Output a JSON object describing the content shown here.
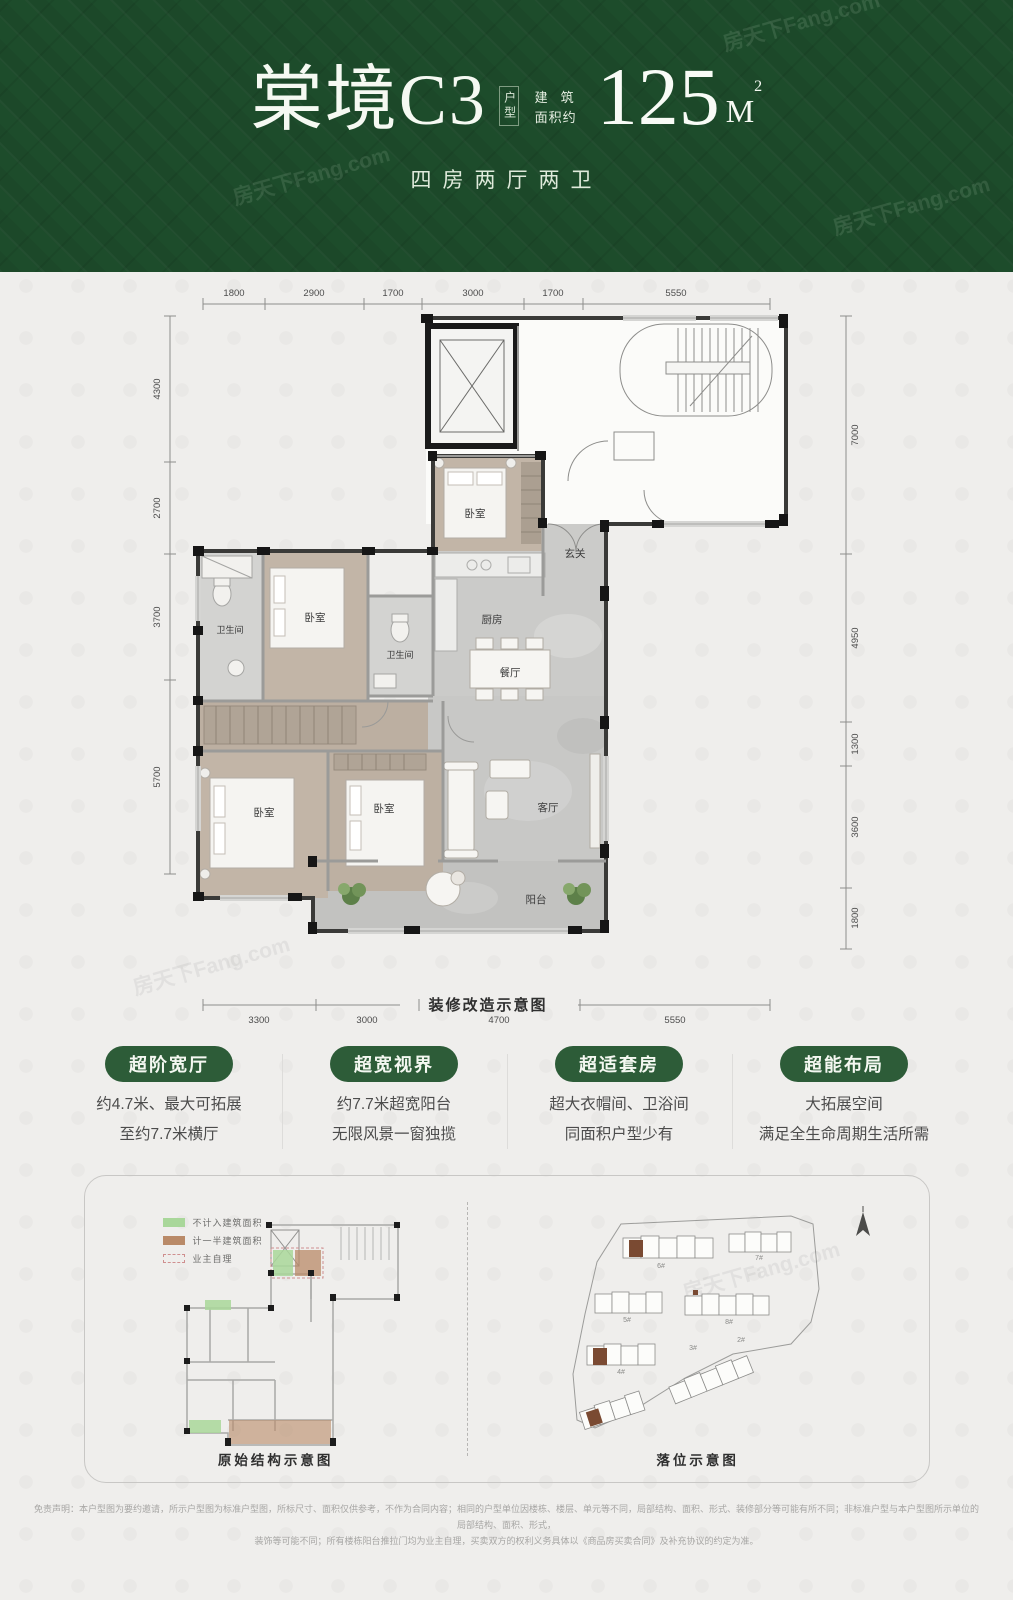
{
  "watermark": "房天下Fang.com",
  "header": {
    "title": "棠境C3",
    "type_label": "户型",
    "area_prefix_line1": "建筑",
    "area_prefix_line2": "面积约",
    "area_value": "125",
    "area_unit": "M",
    "area_sup": "2",
    "subtitle": "四房两厅两卫"
  },
  "floorplan": {
    "caption": "装修改造示意图",
    "dims_top": [
      "1800",
      "2900",
      "1700",
      "3000",
      "1700",
      "5550"
    ],
    "dims_bottom": [
      "3300",
      "3000",
      "4700",
      "5550"
    ],
    "dims_left": [
      "4300",
      "2700",
      "3700",
      "5700"
    ],
    "dims_right": [
      "7000",
      "4950",
      "1300",
      "3600",
      "1800"
    ],
    "rooms": {
      "bedroom": "卧室",
      "bath": "卫生间",
      "kitchen": "厨房",
      "dining": "餐厅",
      "living": "客厅",
      "foyer": "玄关",
      "balcony": "阳台"
    }
  },
  "features": [
    {
      "title": "超阶宽厅",
      "line1": "约4.7米、最大可拓展",
      "line2": "至约7.7米横厅"
    },
    {
      "title": "超宽视界",
      "line1": "约7.7米超宽阳台",
      "line2": "无限风景一窗独揽"
    },
    {
      "title": "超适套房",
      "line1": "超大衣帽间、卫浴间",
      "line2": "同面积户型少有"
    },
    {
      "title": "超能布局",
      "line1": "大拓展空间",
      "line2": "满足全生命周期生活所需"
    }
  ],
  "bottom_panel": {
    "legend": [
      {
        "label": "不计入建筑面积"
      },
      {
        "label": "计一半建筑面积"
      },
      {
        "label": "业主自理"
      }
    ],
    "left_caption": "原始结构示意图",
    "right_caption": "落位示意图",
    "site_buildings": [
      "6#",
      "7#",
      "5#",
      "8#",
      "4#",
      "3#",
      "2#"
    ]
  },
  "disclaimer": {
    "line1": "免责声明：本户型图为要约邀请，所示户型图为标准户型图，所标尺寸、面积仅供参考，不作为合同内容；相同的户型单位因楼栋、楼层、单元等不同，局部结构、面积、形式、装修部分等可能有所不同；非标准户型与本户型图所示单位的局部结构、面积、形式，",
    "line2": "装饰等可能不同；所有楼栋阳台推拉门均为业主自理，买卖双方的权利义务具体以《商品房买卖合同》及补充协议的约定为准。"
  },
  "colors": {
    "header_green": "#1d4c2b",
    "pill_green": "#2d5c38",
    "legend_green": "#a9d79a",
    "legend_brown": "#b98a68"
  }
}
